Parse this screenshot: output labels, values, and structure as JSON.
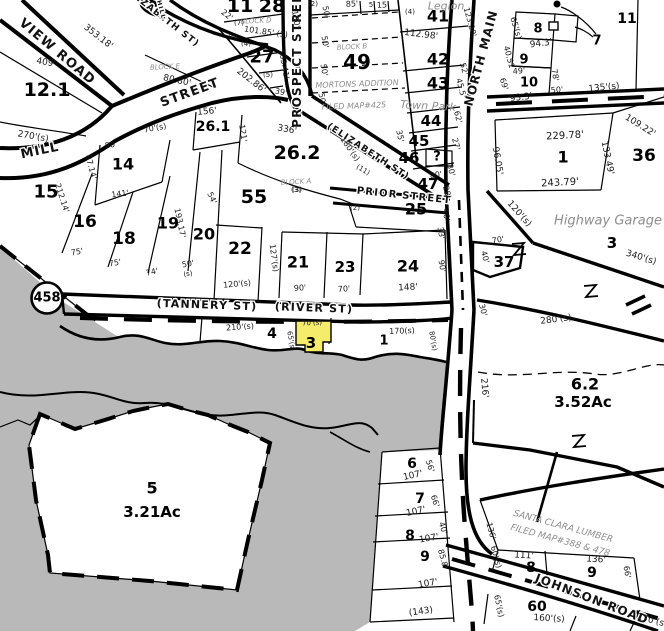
{
  "map": {
    "type": "Tax parcel map — Tannery St / River St at North Main, highlighted parcel 3",
    "route_shield": "458",
    "selected_parcel": {
      "number": "3",
      "frontage": "70'(s)",
      "side": "65'(s)",
      "fill": "#f4ec6a"
    },
    "colors": {
      "background": "#ffffff",
      "line": "#000000",
      "water": "#b9b9b9",
      "annotation": "#8d8d8d",
      "highlight": "#f4ec6a"
    },
    "streets": [
      "VIEW ROAD",
      "MILL",
      "STREET",
      "(ELIZABETH ST)",
      "HILL",
      "PROSPECT STREET",
      "PRIOR STREET",
      "NORTH MAIN",
      "(TANNERY ST)",
      "(RIVER ST)",
      "JOHNSON ROAD"
    ],
    "annotations": [
      "Legion",
      "Town Park",
      "Highway Garage",
      "MORTONS ADDITION",
      "FILED MAP#425",
      "BLOCK A",
      "BLOCK B",
      "BLOCK D",
      "BLOCK E",
      "SANTA CLARA LUMBER",
      "FILED MAP#388 & 478"
    ],
    "acreages": {
      "parcel_6_2": "3.52Ac",
      "parcel_5": "3.21Ac"
    }
  },
  "labels": [
    [
      "VIEW ROAD",
      57,
      52,
      40,
      13,
      "s"
    ],
    [
      "MILL",
      40,
      151,
      -12,
      13,
      "s"
    ],
    [
      "STREET",
      190,
      93,
      -20,
      13,
      "s"
    ],
    [
      "(ELIZABETH ST)",
      160,
      16,
      38,
      9,
      "s"
    ],
    [
      "HILL",
      161,
      10,
      75,
      6,
      "s"
    ],
    [
      "PROSPECT STREET",
      297,
      56,
      -90,
      12,
      "s"
    ],
    [
      "(ELIZABETH ST)",
      368,
      152,
      33,
      9,
      "s"
    ],
    [
      "PRIOR STREET",
      404,
      196,
      6,
      10,
      "s"
    ],
    [
      "NORTH MAIN",
      481,
      58,
      -75,
      12,
      "s"
    ],
    [
      "(TANNERY ST)",
      207,
      305,
      2,
      11,
      "s"
    ],
    [
      "(RIVER ST)",
      314,
      308,
      2,
      11,
      "s"
    ],
    [
      "JOHNSON ROAD",
      592,
      599,
      21,
      12,
      "s"
    ],
    [
      "11",
      240,
      6,
      0,
      19,
      "b"
    ],
    [
      "28",
      272,
      6,
      0,
      19,
      "b"
    ],
    [
      "12.1",
      47,
      90,
      0,
      19,
      "b"
    ],
    [
      "27",
      262,
      57,
      0,
      18,
      "b"
    ],
    [
      "49",
      357,
      62,
      0,
      20,
      "b"
    ],
    [
      "41",
      438,
      16,
      0,
      16,
      "b"
    ],
    [
      "42",
      438,
      59,
      0,
      16,
      "b"
    ],
    [
      "43",
      438,
      83,
      0,
      16,
      "b"
    ],
    [
      "44",
      431,
      121,
      0,
      15,
      "b"
    ],
    [
      "45",
      419,
      141,
      0,
      15,
      "b"
    ],
    [
      "46",
      409,
      158,
      0,
      15,
      "b"
    ],
    [
      "?",
      437,
      157,
      0,
      13,
      "b"
    ],
    [
      "47",
      428,
      184,
      0,
      15,
      "b"
    ],
    [
      "25",
      416,
      209,
      0,
      16,
      "b"
    ],
    [
      "26.1",
      213,
      127,
      0,
      14,
      "b"
    ],
    [
      "26.2",
      297,
      153,
      0,
      19,
      "b"
    ],
    [
      "55",
      254,
      197,
      0,
      19,
      "b"
    ],
    [
      "14",
      123,
      164,
      0,
      16,
      "b"
    ],
    [
      "15",
      46,
      192,
      0,
      18,
      "b"
    ],
    [
      "16",
      85,
      222,
      0,
      17,
      "b"
    ],
    [
      "18",
      124,
      239,
      0,
      17,
      "b"
    ],
    [
      "19",
      168,
      223,
      0,
      16,
      "b"
    ],
    [
      "20",
      204,
      234,
      0,
      16,
      "b"
    ],
    [
      "22",
      240,
      249,
      0,
      17,
      "b"
    ],
    [
      "21",
      298,
      262,
      0,
      16,
      "b"
    ],
    [
      "23",
      345,
      267,
      0,
      15,
      "b"
    ],
    [
      "24",
      408,
      266,
      0,
      16,
      "b"
    ],
    [
      "37",
      504,
      262,
      0,
      15,
      "b"
    ],
    [
      "36",
      644,
      156,
      0,
      17,
      "b"
    ],
    [
      "1",
      563,
      157,
      0,
      16,
      "b"
    ],
    [
      "3",
      612,
      243,
      0,
      15,
      "b"
    ],
    [
      "6.2",
      585,
      384,
      0,
      16,
      "b"
    ],
    [
      "3.52Ac",
      583,
      402,
      0,
      15,
      "b"
    ],
    [
      "5",
      152,
      488,
      0,
      16,
      "b"
    ],
    [
      "3.21Ac",
      152,
      512,
      0,
      15,
      "b"
    ],
    [
      "4",
      272,
      334,
      0,
      14,
      "b"
    ],
    [
      "3",
      311,
      343,
      0,
      15,
      "b"
    ],
    [
      "1",
      384,
      341,
      0,
      13,
      "b"
    ],
    [
      "6",
      412,
      464,
      0,
      14,
      "b"
    ],
    [
      "7",
      420,
      499,
      0,
      14,
      "b"
    ],
    [
      "8",
      410,
      536,
      0,
      14,
      "b"
    ],
    [
      "9",
      425,
      557,
      0,
      14,
      "b"
    ],
    [
      "8",
      531,
      568,
      0,
      14,
      "b"
    ],
    [
      "9",
      592,
      573,
      0,
      14,
      "b"
    ],
    [
      "60",
      537,
      607,
      0,
      14,
      "b"
    ],
    [
      "8",
      538,
      29,
      0,
      13,
      "b"
    ],
    [
      "9",
      524,
      60,
      0,
      13,
      "b"
    ],
    [
      "10",
      529,
      83,
      0,
      13,
      "b"
    ],
    [
      "7",
      597,
      41,
      0,
      13,
      "b"
    ],
    [
      "11",
      627,
      19,
      0,
      14,
      "b"
    ],
    [
      "Legion",
      446,
      6,
      0,
      11,
      "g"
    ],
    [
      "Town Park",
      428,
      106,
      3,
      11,
      "g"
    ],
    [
      "Highway Garage",
      608,
      221,
      0,
      13,
      "g"
    ],
    [
      "MORTONS ADDITION",
      357,
      84,
      -2,
      8,
      "g"
    ],
    [
      "FILED MAP#425",
      354,
      106,
      -2,
      8,
      "g"
    ],
    [
      "BLOCK D",
      256,
      21,
      -3,
      7,
      "g"
    ],
    [
      "BLOCK B",
      352,
      47,
      -3,
      7,
      "g"
    ],
    [
      "BLOCK E",
      165,
      67,
      -3,
      7,
      "g"
    ],
    [
      "BLOCK A",
      296,
      182,
      -3,
      7,
      "g"
    ],
    [
      "SANTA CLARA LUMBER",
      563,
      527,
      15,
      9,
      "g"
    ],
    [
      "FILED MAP#388 & 478",
      560,
      541,
      15,
      9,
      "g"
    ],
    [
      "353.18'",
      98,
      37,
      38,
      9,
      "d"
    ],
    [
      "409'",
      46,
      63,
      10,
      9,
      "d"
    ],
    [
      "270'(s)",
      33,
      137,
      10,
      9,
      "d"
    ],
    [
      "80.80'",
      177,
      81,
      12,
      9,
      "d"
    ],
    [
      "156'",
      207,
      112,
      -5,
      9,
      "d"
    ],
    [
      "121'",
      243,
      133,
      82,
      8,
      "d"
    ],
    [
      "336'",
      287,
      130,
      10,
      9,
      "d"
    ],
    [
      "101.85' (3)",
      266,
      32,
      8,
      8,
      "d"
    ],
    [
      "22'",
      227,
      15,
      38,
      8,
      "d"
    ],
    [
      "(7)",
      239,
      23,
      0,
      7,
      "d"
    ],
    [
      "(6)",
      233,
      38,
      0,
      7,
      "d"
    ],
    [
      "(4)",
      246,
      44,
      0,
      7,
      "d"
    ],
    [
      "(5)",
      268,
      75,
      0,
      7,
      "d"
    ],
    [
      "202.86'",
      251,
      81,
      38,
      9,
      "d"
    ],
    [
      "39'",
      281,
      92,
      10,
      8,
      "d"
    ],
    [
      "103.41'",
      284,
      64,
      80,
      8,
      "d"
    ],
    [
      "180'",
      296,
      19,
      80,
      8,
      "d"
    ],
    [
      "50'",
      326,
      12,
      80,
      8,
      "d"
    ],
    [
      "50'",
      325,
      42,
      80,
      8,
      "d"
    ],
    [
      "50'",
      324,
      70,
      80,
      8,
      "d"
    ],
    [
      "50'",
      322,
      99,
      80,
      8,
      "d"
    ],
    [
      "85'",
      352,
      4,
      -4,
      8,
      "d"
    ],
    [
      "5",
      371,
      5,
      0,
      7,
      "d"
    ],
    [
      "15'",
      383,
      5,
      -4,
      8,
      "d"
    ],
    [
      "(4)",
      410,
      12,
      0,
      7,
      "d"
    ],
    [
      "(2)",
      313,
      4,
      0,
      7,
      "d"
    ],
    [
      "112.98'",
      421,
      35,
      7,
      9,
      "d"
    ],
    [
      "123.20'",
      470,
      22,
      75,
      8,
      "d"
    ],
    [
      "65'(s)",
      516,
      28,
      73,
      8,
      "d"
    ],
    [
      "94.3'",
      541,
      44,
      -7,
      9,
      "d"
    ],
    [
      "40.51",
      509,
      57,
      75,
      8,
      "d"
    ],
    [
      "49'",
      519,
      71,
      -5,
      8,
      "d"
    ],
    [
      "69'",
      504,
      84,
      73,
      8,
      "d"
    ],
    [
      "78'",
      555,
      75,
      80,
      8,
      "d"
    ],
    [
      "50'",
      557,
      90,
      -5,
      8,
      "d"
    ],
    [
      "93.3'",
      521,
      98,
      -7,
      9,
      "d"
    ],
    [
      "135'(s)",
      604,
      88,
      -6,
      9,
      "d"
    ],
    [
      "52'",
      464,
      69,
      75,
      8,
      "d"
    ],
    [
      "45.5'",
      461,
      88,
      75,
      8,
      "d"
    ],
    [
      "62'",
      458,
      117,
      75,
      8,
      "d"
    ],
    [
      "35'",
      400,
      136,
      78,
      8,
      "d"
    ],
    [
      "27'",
      456,
      144,
      75,
      8,
      "d"
    ],
    [
      "30'",
      451,
      170,
      75,
      8,
      "d"
    ],
    [
      "80'",
      436,
      175,
      -8,
      8,
      "d"
    ],
    [
      "28'",
      447,
      192,
      75,
      8,
      "d"
    ],
    [
      "229.78'",
      565,
      136,
      -3,
      10,
      "d"
    ],
    [
      "96.05'",
      497,
      161,
      80,
      9,
      "d"
    ],
    [
      "133.49'",
      607,
      158,
      78,
      9,
      "d"
    ],
    [
      "243.79'",
      560,
      183,
      -3,
      10,
      "d"
    ],
    [
      "109.22'",
      640,
      126,
      32,
      9,
      "d"
    ],
    [
      "120'(s)",
      519,
      214,
      48,
      9,
      "d"
    ],
    [
      "340'(s)",
      641,
      258,
      17,
      9,
      "d"
    ],
    [
      "280'(s)",
      556,
      320,
      -7,
      9,
      "d"
    ],
    [
      "70'",
      498,
      240,
      -10,
      8,
      "d"
    ],
    [
      "40'",
      485,
      257,
      75,
      8,
      "d"
    ],
    [
      "30'",
      483,
      310,
      75,
      8,
      "d"
    ],
    [
      "90'",
      442,
      266,
      80,
      8,
      "d"
    ],
    [
      "33'",
      441,
      233,
      80,
      8,
      "d"
    ],
    [
      "40'",
      446,
      215,
      80,
      8,
      "d"
    ],
    [
      "70'(s)",
      155,
      128,
      -10,
      8,
      "d"
    ],
    [
      "80'",
      111,
      145,
      -8,
      8,
      "d"
    ],
    [
      "87.14'",
      91,
      167,
      75,
      8,
      "d"
    ],
    [
      "212.14'",
      62,
      198,
      72,
      8,
      "d"
    ],
    [
      "141'",
      120,
      194,
      -7,
      8,
      "d"
    ],
    [
      "54'",
      212,
      198,
      65,
      8,
      "d"
    ],
    [
      "193.17'",
      180,
      223,
      78,
      8,
      "d"
    ],
    [
      "75'",
      77,
      252,
      -10,
      8,
      "d"
    ],
    [
      "75'",
      115,
      263,
      -10,
      8,
      "d"
    ],
    [
      "74'",
      152,
      272,
      -12,
      8,
      "d"
    ],
    [
      "50'",
      188,
      264,
      -10,
      8,
      "d"
    ],
    [
      "(s)",
      188,
      274,
      -10,
      7,
      "d"
    ],
    [
      "120'(s)",
      237,
      284,
      -5,
      8,
      "d"
    ],
    [
      "127'(s)",
      274,
      258,
      82,
      8,
      "d"
    ],
    [
      "90'",
      300,
      288,
      -4,
      8,
      "d"
    ],
    [
      "70'",
      344,
      289,
      -4,
      8,
      "d"
    ],
    [
      "148'",
      408,
      288,
      -3,
      9,
      "d"
    ],
    [
      "(2)",
      355,
      208,
      0,
      7,
      "d"
    ],
    [
      "(3)",
      296,
      190,
      0,
      7,
      "d"
    ],
    [
      "(3)",
      297,
      190,
      0,
      7,
      "d"
    ],
    [
      "(11)",
      363,
      170,
      30,
      7,
      "d"
    ],
    [
      "180'(s)",
      350,
      149,
      55,
      8,
      "d"
    ],
    [
      "210'(s)",
      240,
      327,
      -4,
      8,
      "d"
    ],
    [
      "70'(s)",
      312,
      323,
      -3,
      7,
      "d"
    ],
    [
      "65'(s)",
      291,
      341,
      80,
      7,
      "d"
    ],
    [
      "170(s)",
      402,
      331,
      -2,
      8,
      "d"
    ],
    [
      "80'(s)",
      433,
      341,
      80,
      7,
      "d"
    ],
    [
      "216'",
      484,
      388,
      85,
      9,
      "d"
    ],
    [
      "107'",
      413,
      476,
      -12,
      9,
      "d"
    ],
    [
      "107'",
      416,
      512,
      -12,
      9,
      "d"
    ],
    [
      "107'",
      429,
      539,
      -10,
      9,
      "d"
    ],
    [
      "107'",
      428,
      584,
      -10,
      9,
      "d"
    ],
    [
      "56'",
      430,
      466,
      72,
      8,
      "d"
    ],
    [
      "66'",
      435,
      501,
      72,
      8,
      "d"
    ],
    [
      "40'",
      443,
      528,
      72,
      8,
      "d"
    ],
    [
      "85.8'",
      443,
      559,
      75,
      8,
      "d"
    ],
    [
      "(143)",
      421,
      612,
      -8,
      9,
      "d"
    ],
    [
      "136'",
      491,
      531,
      75,
      8,
      "d"
    ],
    [
      "60'(s)",
      496,
      557,
      75,
      8,
      "d"
    ],
    [
      "111'",
      524,
      556,
      3,
      9,
      "d"
    ],
    [
      "136'",
      596,
      560,
      3,
      9,
      "d"
    ],
    [
      "66'",
      627,
      572,
      80,
      8,
      "d"
    ],
    [
      "65'(s)",
      499,
      606,
      78,
      8,
      "d"
    ],
    [
      "160'(s)",
      549,
      619,
      3,
      9,
      "d"
    ],
    [
      "170'(s)",
      652,
      621,
      15,
      9,
      "d"
    ],
    [
      "458",
      47,
      298,
      0,
      13,
      "r"
    ]
  ]
}
